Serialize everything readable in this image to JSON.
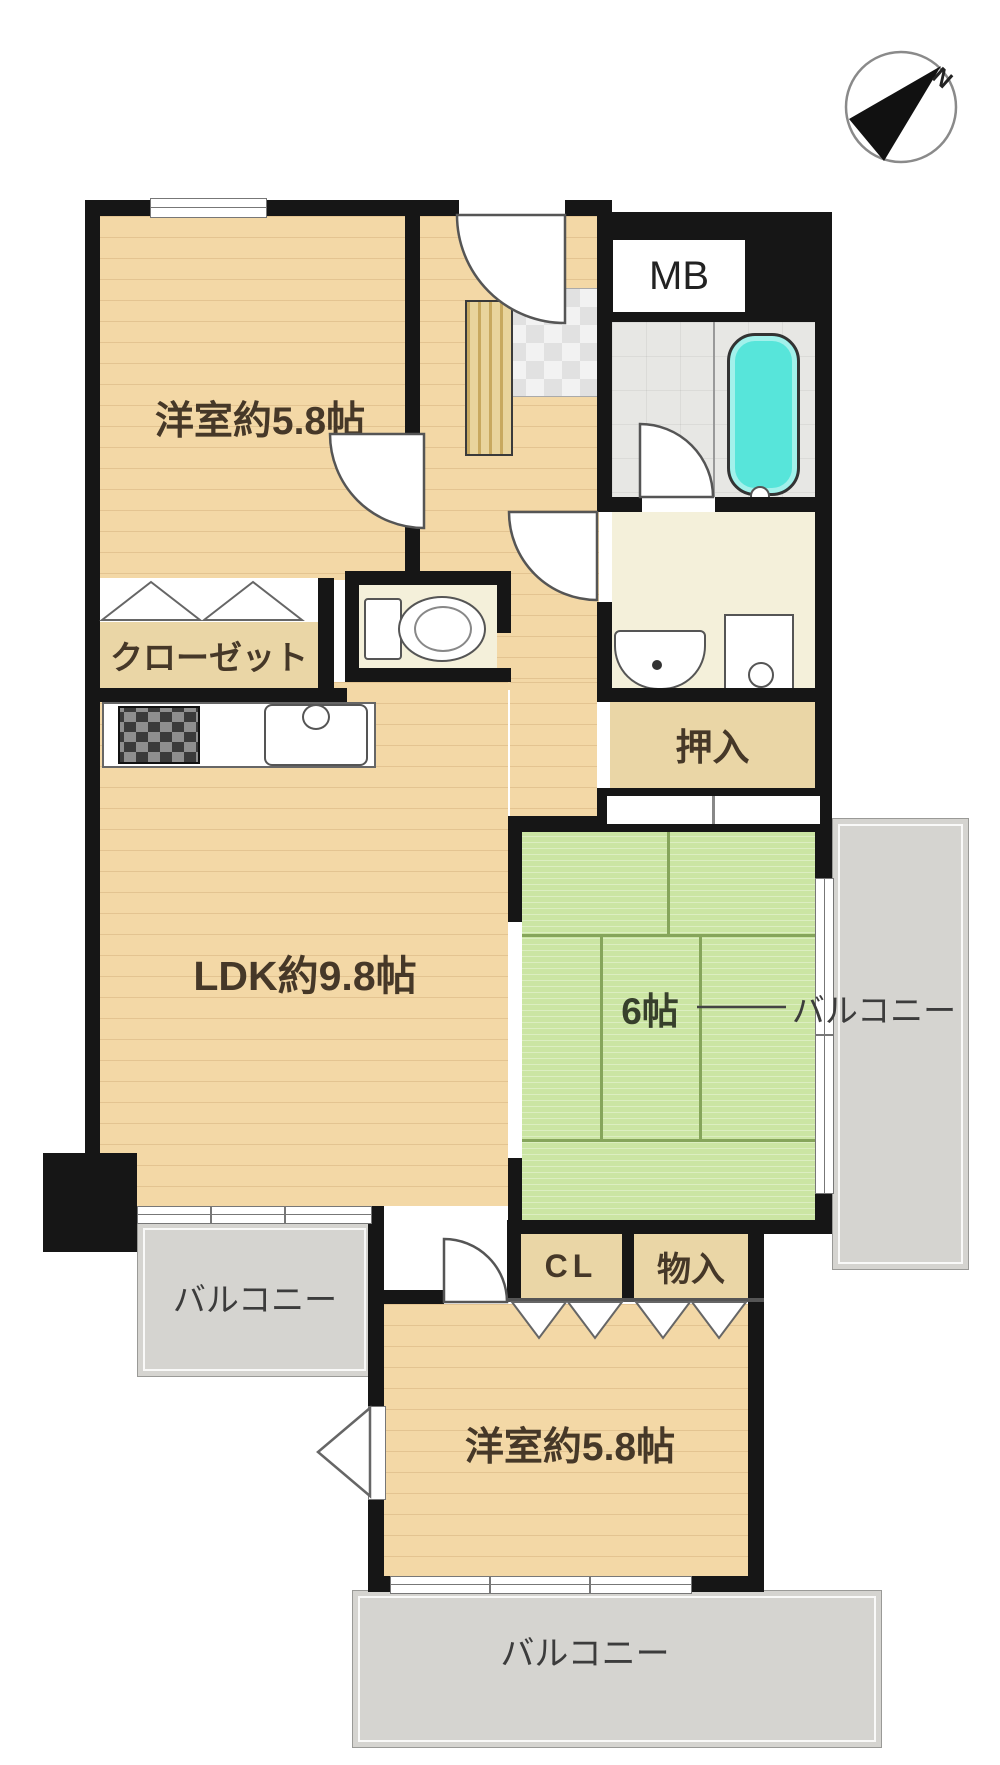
{
  "title": "apartment-floor-plan",
  "labels": {
    "bedroom_top": "洋室約5.8帖",
    "meter_box": "MB",
    "closet": "クローゼット",
    "oshiire": "押入",
    "ldk": "LDK約9.8帖",
    "tatami": "6帖",
    "balcony_right": "バルコニー",
    "balcony_left": "バルコニー",
    "closet_cl": "CL",
    "storage": "物入",
    "bedroom_bottom": "洋室約5.8帖",
    "balcony_bottom": "バルコニー"
  },
  "compass": {
    "north": "N"
  },
  "colors": {
    "wall": "#161616",
    "wood_floor": "#f3d8a6",
    "tatami_green": "#cbe5a3",
    "balcony_gray": "#d5d4d0",
    "bathtub_cyan": "#57e5da",
    "wet_room_cream": "#f4f0da",
    "closet_tan": "#ead6a6"
  }
}
